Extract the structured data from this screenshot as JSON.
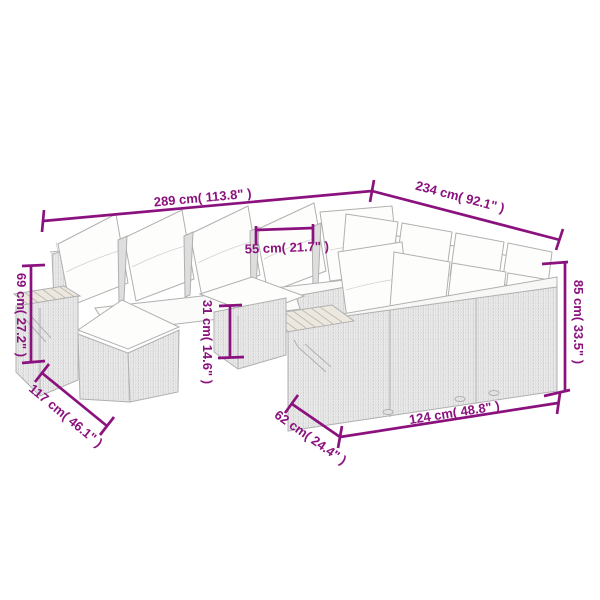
{
  "diagram": {
    "kind": "product-dimension-diagram",
    "subject": "wicker-sectional-sofa-set-line-art"
  },
  "colors": {
    "dimension_line": "#8B127E",
    "artwork_outline": "#B0B0B0",
    "cushion_fill": "#FDFDFB",
    "wicker_fill": "#EDEDED",
    "wood_fill": "#ECE8E0",
    "background": "#FFFFFF"
  },
  "dimensions": [
    {
      "id": "overall-width",
      "label": "289 cm( 113.8\" )"
    },
    {
      "id": "overall-depth",
      "label": "234 cm( 92.1\" )"
    },
    {
      "id": "seat-width",
      "label": "55 cm( 21.7\" )"
    },
    {
      "id": "arm-height",
      "label": "69 cm( 27.2\" )"
    },
    {
      "id": "left-side-depth",
      "label": "117 cm( 46.1\" )"
    },
    {
      "id": "seat-height",
      "label": "31 cm( 14.6\" )"
    },
    {
      "id": "module-depth",
      "label": "62 cm( 24.4\" )"
    },
    {
      "id": "module-width",
      "label": "124 cm( 48.8\" )"
    },
    {
      "id": "back-height",
      "label": "85 cm( 33.5\" )"
    }
  ]
}
